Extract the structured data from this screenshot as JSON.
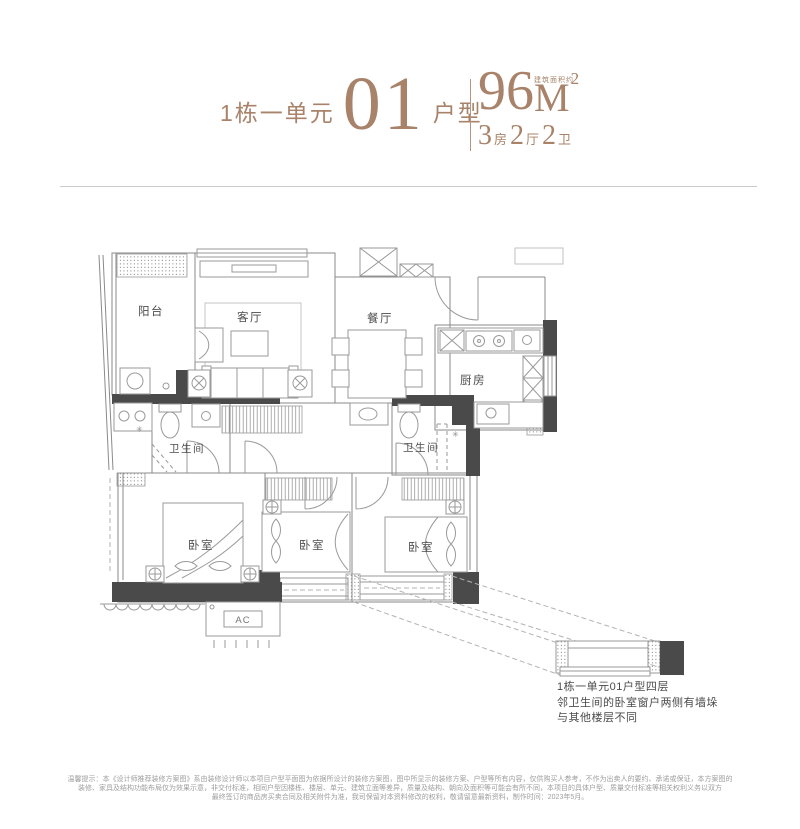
{
  "colors": {
    "accent": "#a8836a",
    "wall_dark": "#4a4a4a",
    "line_gray": "#8a8a8a"
  },
  "header": {
    "title": {
      "prefix": "1栋一单元",
      "number": "01",
      "suffix": "户型"
    },
    "area": {
      "note": "建筑面积约",
      "value": "96",
      "unit": "M",
      "sup": "2"
    },
    "spec": {
      "n1": "3",
      "l1": "房",
      "n2": "2",
      "l2": "厅",
      "n3": "2",
      "l3": "卫"
    }
  },
  "plan": {
    "labels": {
      "balcony": "阳台",
      "living": "客厅",
      "dining": "餐厅",
      "kitchen": "厨房",
      "bath_left": "卫生间",
      "bath_right": "卫生间",
      "bedroom_left": "卧室",
      "bedroom_mid": "卧室",
      "bedroom_right": "卧室",
      "ac": "AC"
    }
  },
  "note": {
    "line1": "1栋一单元01户型四层",
    "line2": "邻卫生间的卧室窗户两侧有墙垛",
    "line3": "与其他楼层不同"
  },
  "disclaimer": {
    "line1": "温馨提示：本《设计师推荐装修方案图》系由装修设计师以本项目户型平面图为依据所设计的装修方案图，图中所显示的装修方案、户型等所有内容，仅供购买人参考，不作为出卖人的要约、承诺或保证，本方案图的",
    "line2": "装修、家具及结构功能布局仅为效果示意，非交付标准，相同户型因楼栋、楼层、单元、建筑立面等差异，质量及结构、朝向及面积等可能会有所不同，本项目的具体户型、质量交付标准等相关权利义务以双方",
    "line3": "最终签订的商品房买卖合同及相关附件为准，我司保留对本资料修改的权利，敬请留意最新资料，制作时间：2023年5月。"
  }
}
